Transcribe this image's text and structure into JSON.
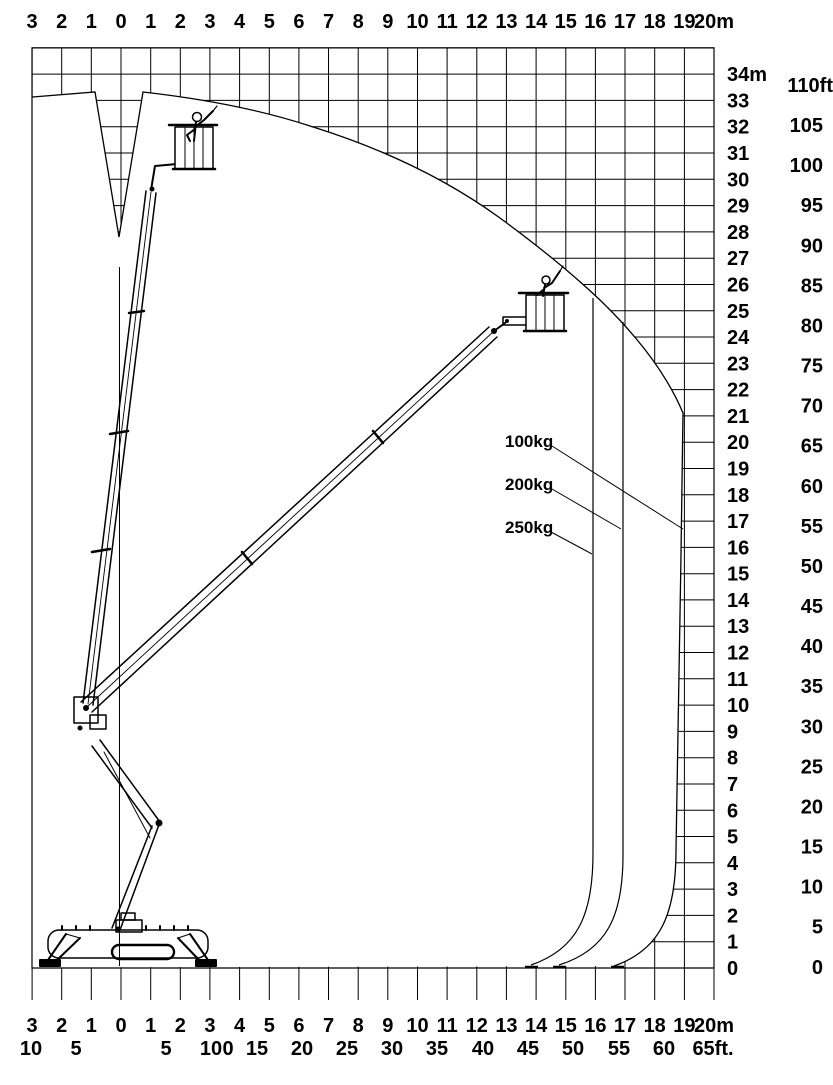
{
  "colors": {
    "ink": "#000000",
    "paper": "#ffffff"
  },
  "axes": {
    "top_meters": [
      "3",
      "2",
      "1",
      "0",
      "1",
      "2",
      "3",
      "4",
      "5",
      "6",
      "7",
      "8",
      "9",
      "10",
      "11",
      "12",
      "13",
      "14",
      "15",
      "16",
      "17",
      "18",
      "19",
      "20m"
    ],
    "bottom_meters": [
      "3",
      "2",
      "1",
      "0",
      "1",
      "2",
      "3",
      "4",
      "5",
      "6",
      "7",
      "8",
      "9",
      "10",
      "11",
      "12",
      "13",
      "14",
      "15",
      "16",
      "17",
      "18",
      "19",
      "20m"
    ],
    "bottom_feet": [
      "10",
      "5",
      "5",
      "10",
      "0",
      "15",
      "20",
      "25",
      "30",
      "35",
      "40",
      "45",
      "50",
      "55",
      "60",
      "65ft."
    ],
    "right_meters": [
      "34m",
      "33",
      "32",
      "31",
      "30",
      "29",
      "28",
      "27",
      "26",
      "25",
      "24",
      "23",
      "22",
      "21",
      "20",
      "19",
      "18",
      "17",
      "16",
      "15",
      "14",
      "13",
      "12",
      "11",
      "10",
      "9",
      "8",
      "7",
      "6",
      "5",
      "4",
      "3",
      "2",
      "1",
      "0"
    ],
    "right_feet": [
      "110ft",
      "105",
      "100",
      "95",
      "90",
      "85",
      "80",
      "75",
      "70",
      "65",
      "60",
      "55",
      "50",
      "45",
      "40",
      "35",
      "30",
      "25",
      "20",
      "15",
      "10",
      "5",
      "0"
    ]
  },
  "load_labels": [
    {
      "label": "100kg"
    },
    {
      "label": "200kg"
    },
    {
      "label": "250kg"
    }
  ],
  "chart_data": {
    "type": "working-envelope-diagram",
    "x_axis": {
      "units": [
        "m",
        "ft"
      ],
      "range_m": [
        -3,
        20
      ]
    },
    "y_axis": {
      "units": [
        "m",
        "ft"
      ],
      "range_m": [
        0,
        34
      ],
      "range_ft": [
        0,
        110
      ]
    },
    "max_working_height_m": 33,
    "curves": [
      {
        "load": "100kg",
        "max_outreach_m": 19
      },
      {
        "load": "200kg",
        "max_outreach_m": 17
      },
      {
        "load": "250kg",
        "max_outreach_m": 16
      }
    ]
  }
}
